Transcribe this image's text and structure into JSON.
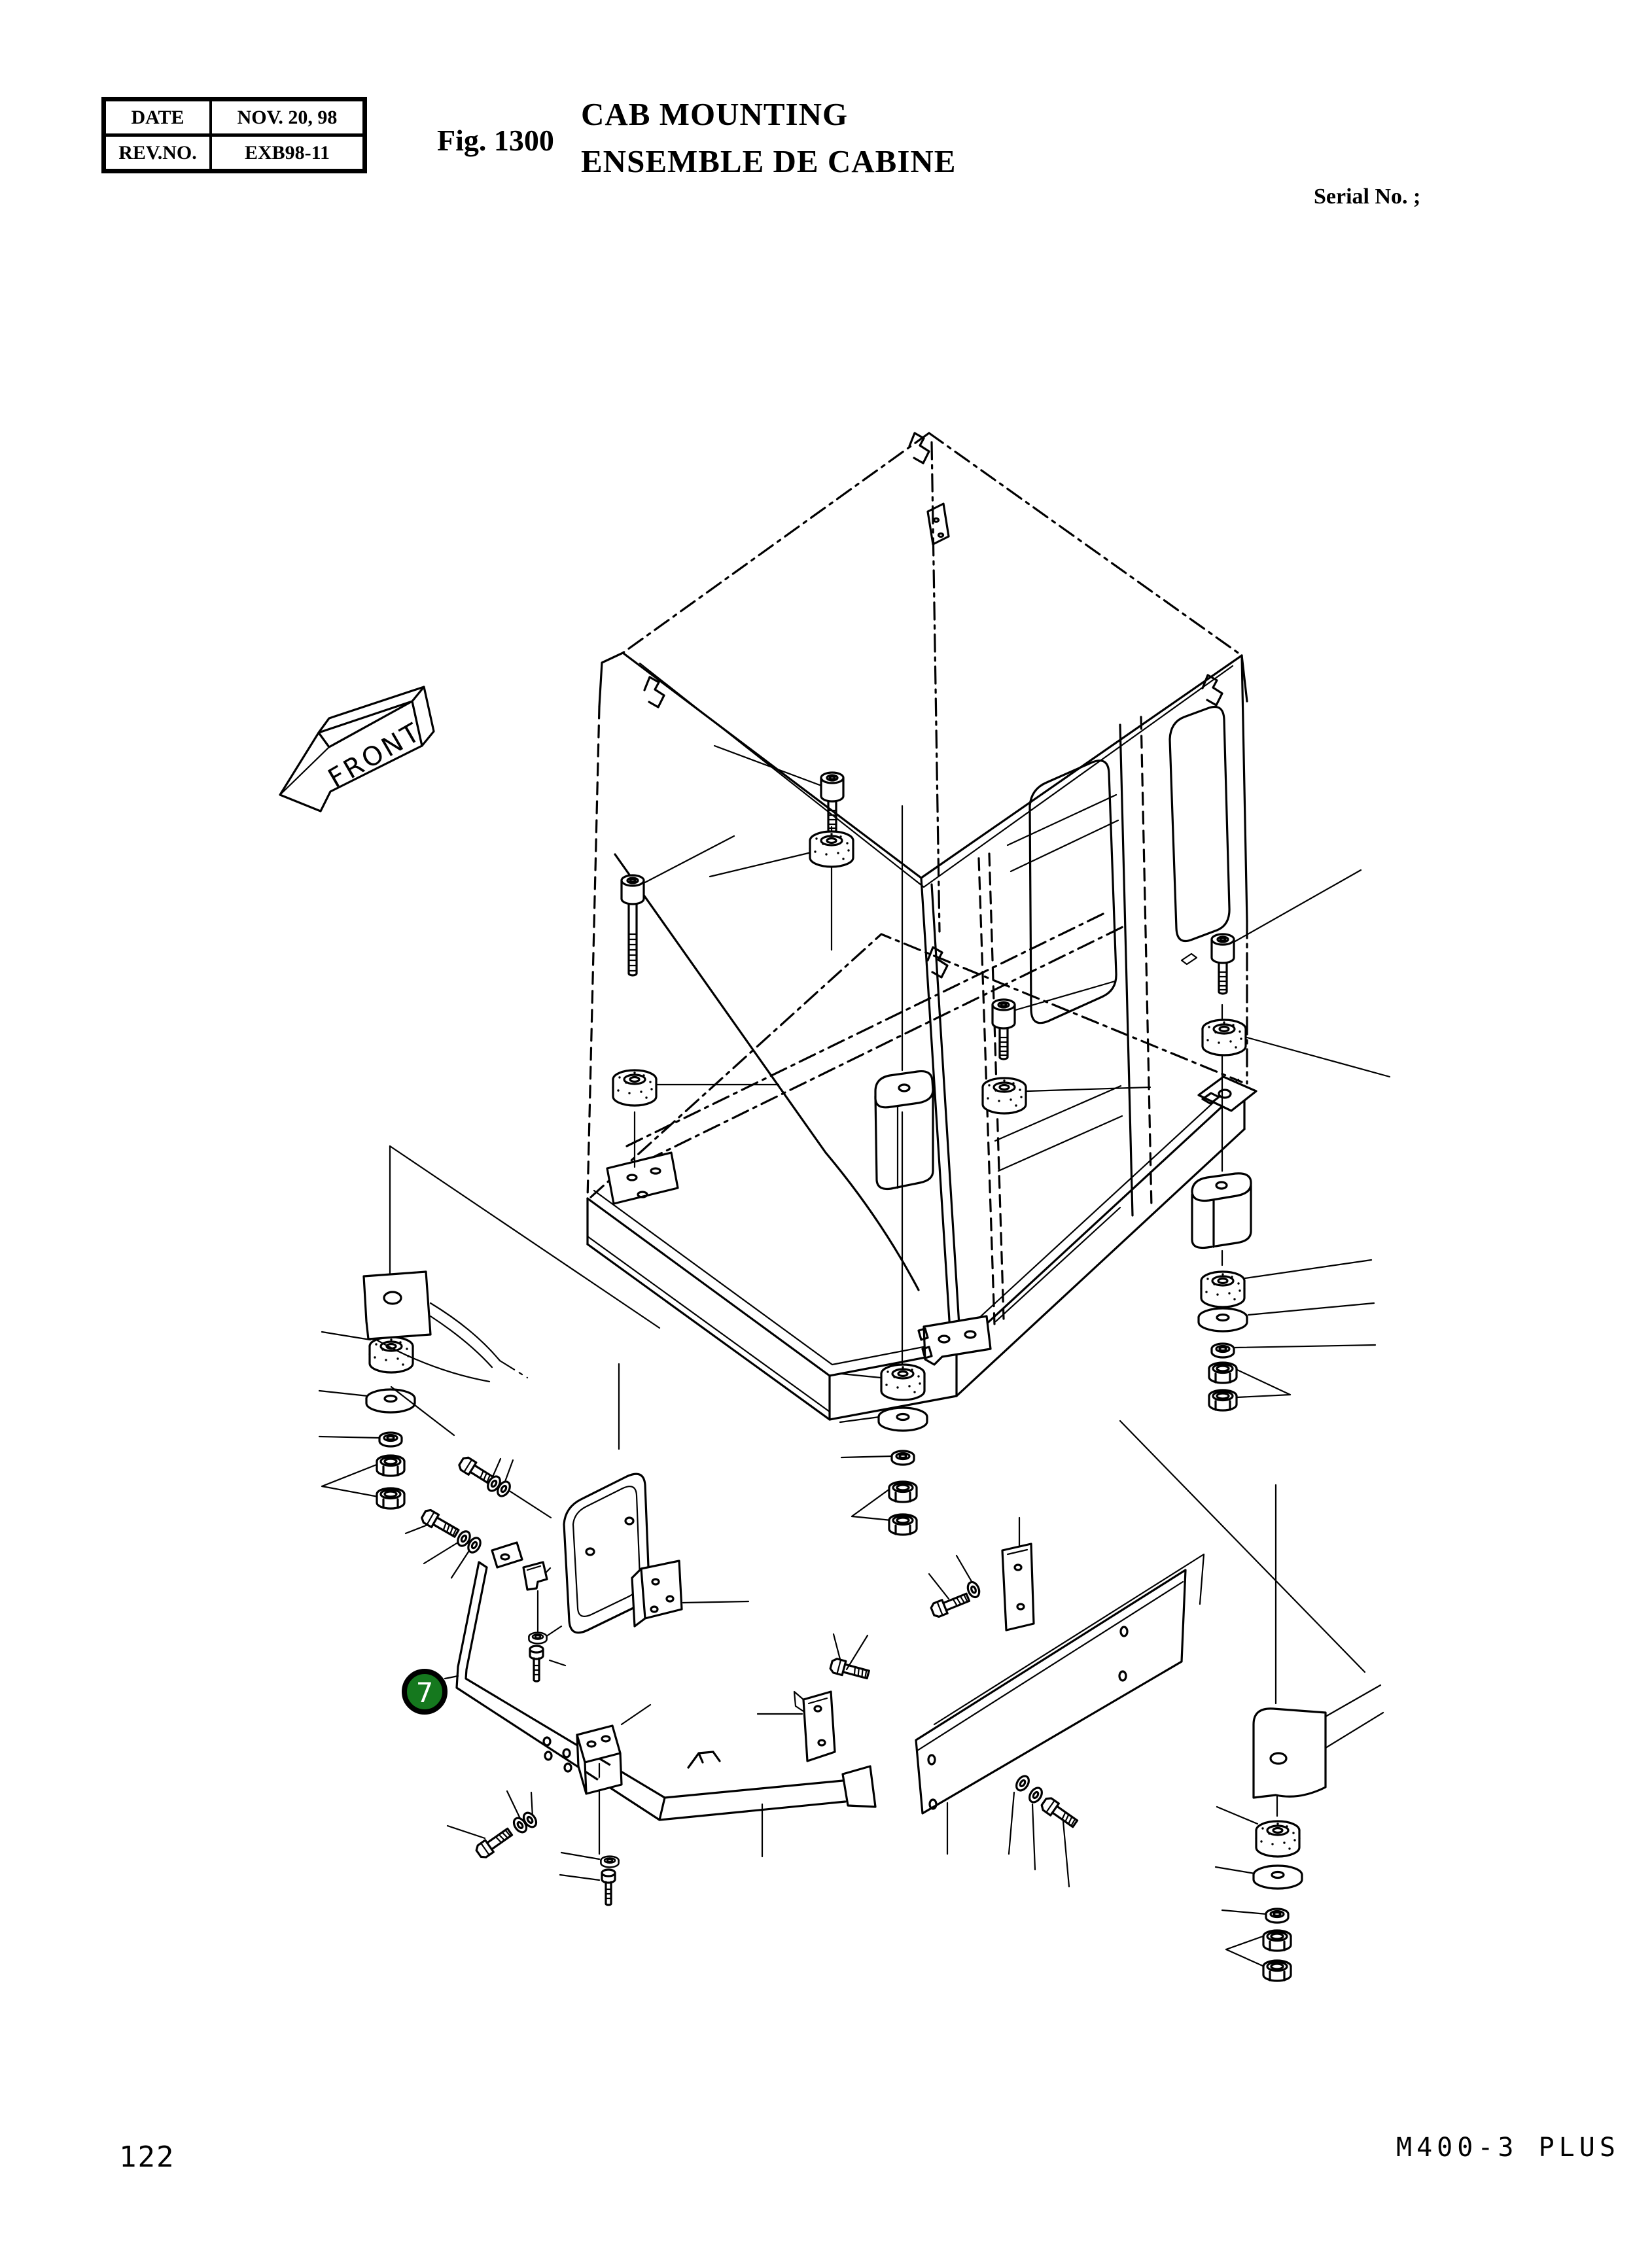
{
  "header": {
    "info_table": {
      "rows": [
        {
          "label": "DATE",
          "value": "NOV. 20, 98"
        },
        {
          "label": "REV.NO.",
          "value": "EXB98-11"
        }
      ]
    },
    "figure_label": "Fig. 1300",
    "title_en": "CAB MOUNTING",
    "title_fr": "ENSEMBLE DE CABINE",
    "serial_label": "Serial No. ;"
  },
  "diagram": {
    "front_label": "FRONT",
    "balloon": {
      "number": "7",
      "fill": "#15781e",
      "text_color": "#ffffff"
    },
    "ink_color": "#000000",
    "paper_color": "#ffffff"
  },
  "footer": {
    "page_number": "122",
    "model_code": "M400-3 PLUS"
  }
}
